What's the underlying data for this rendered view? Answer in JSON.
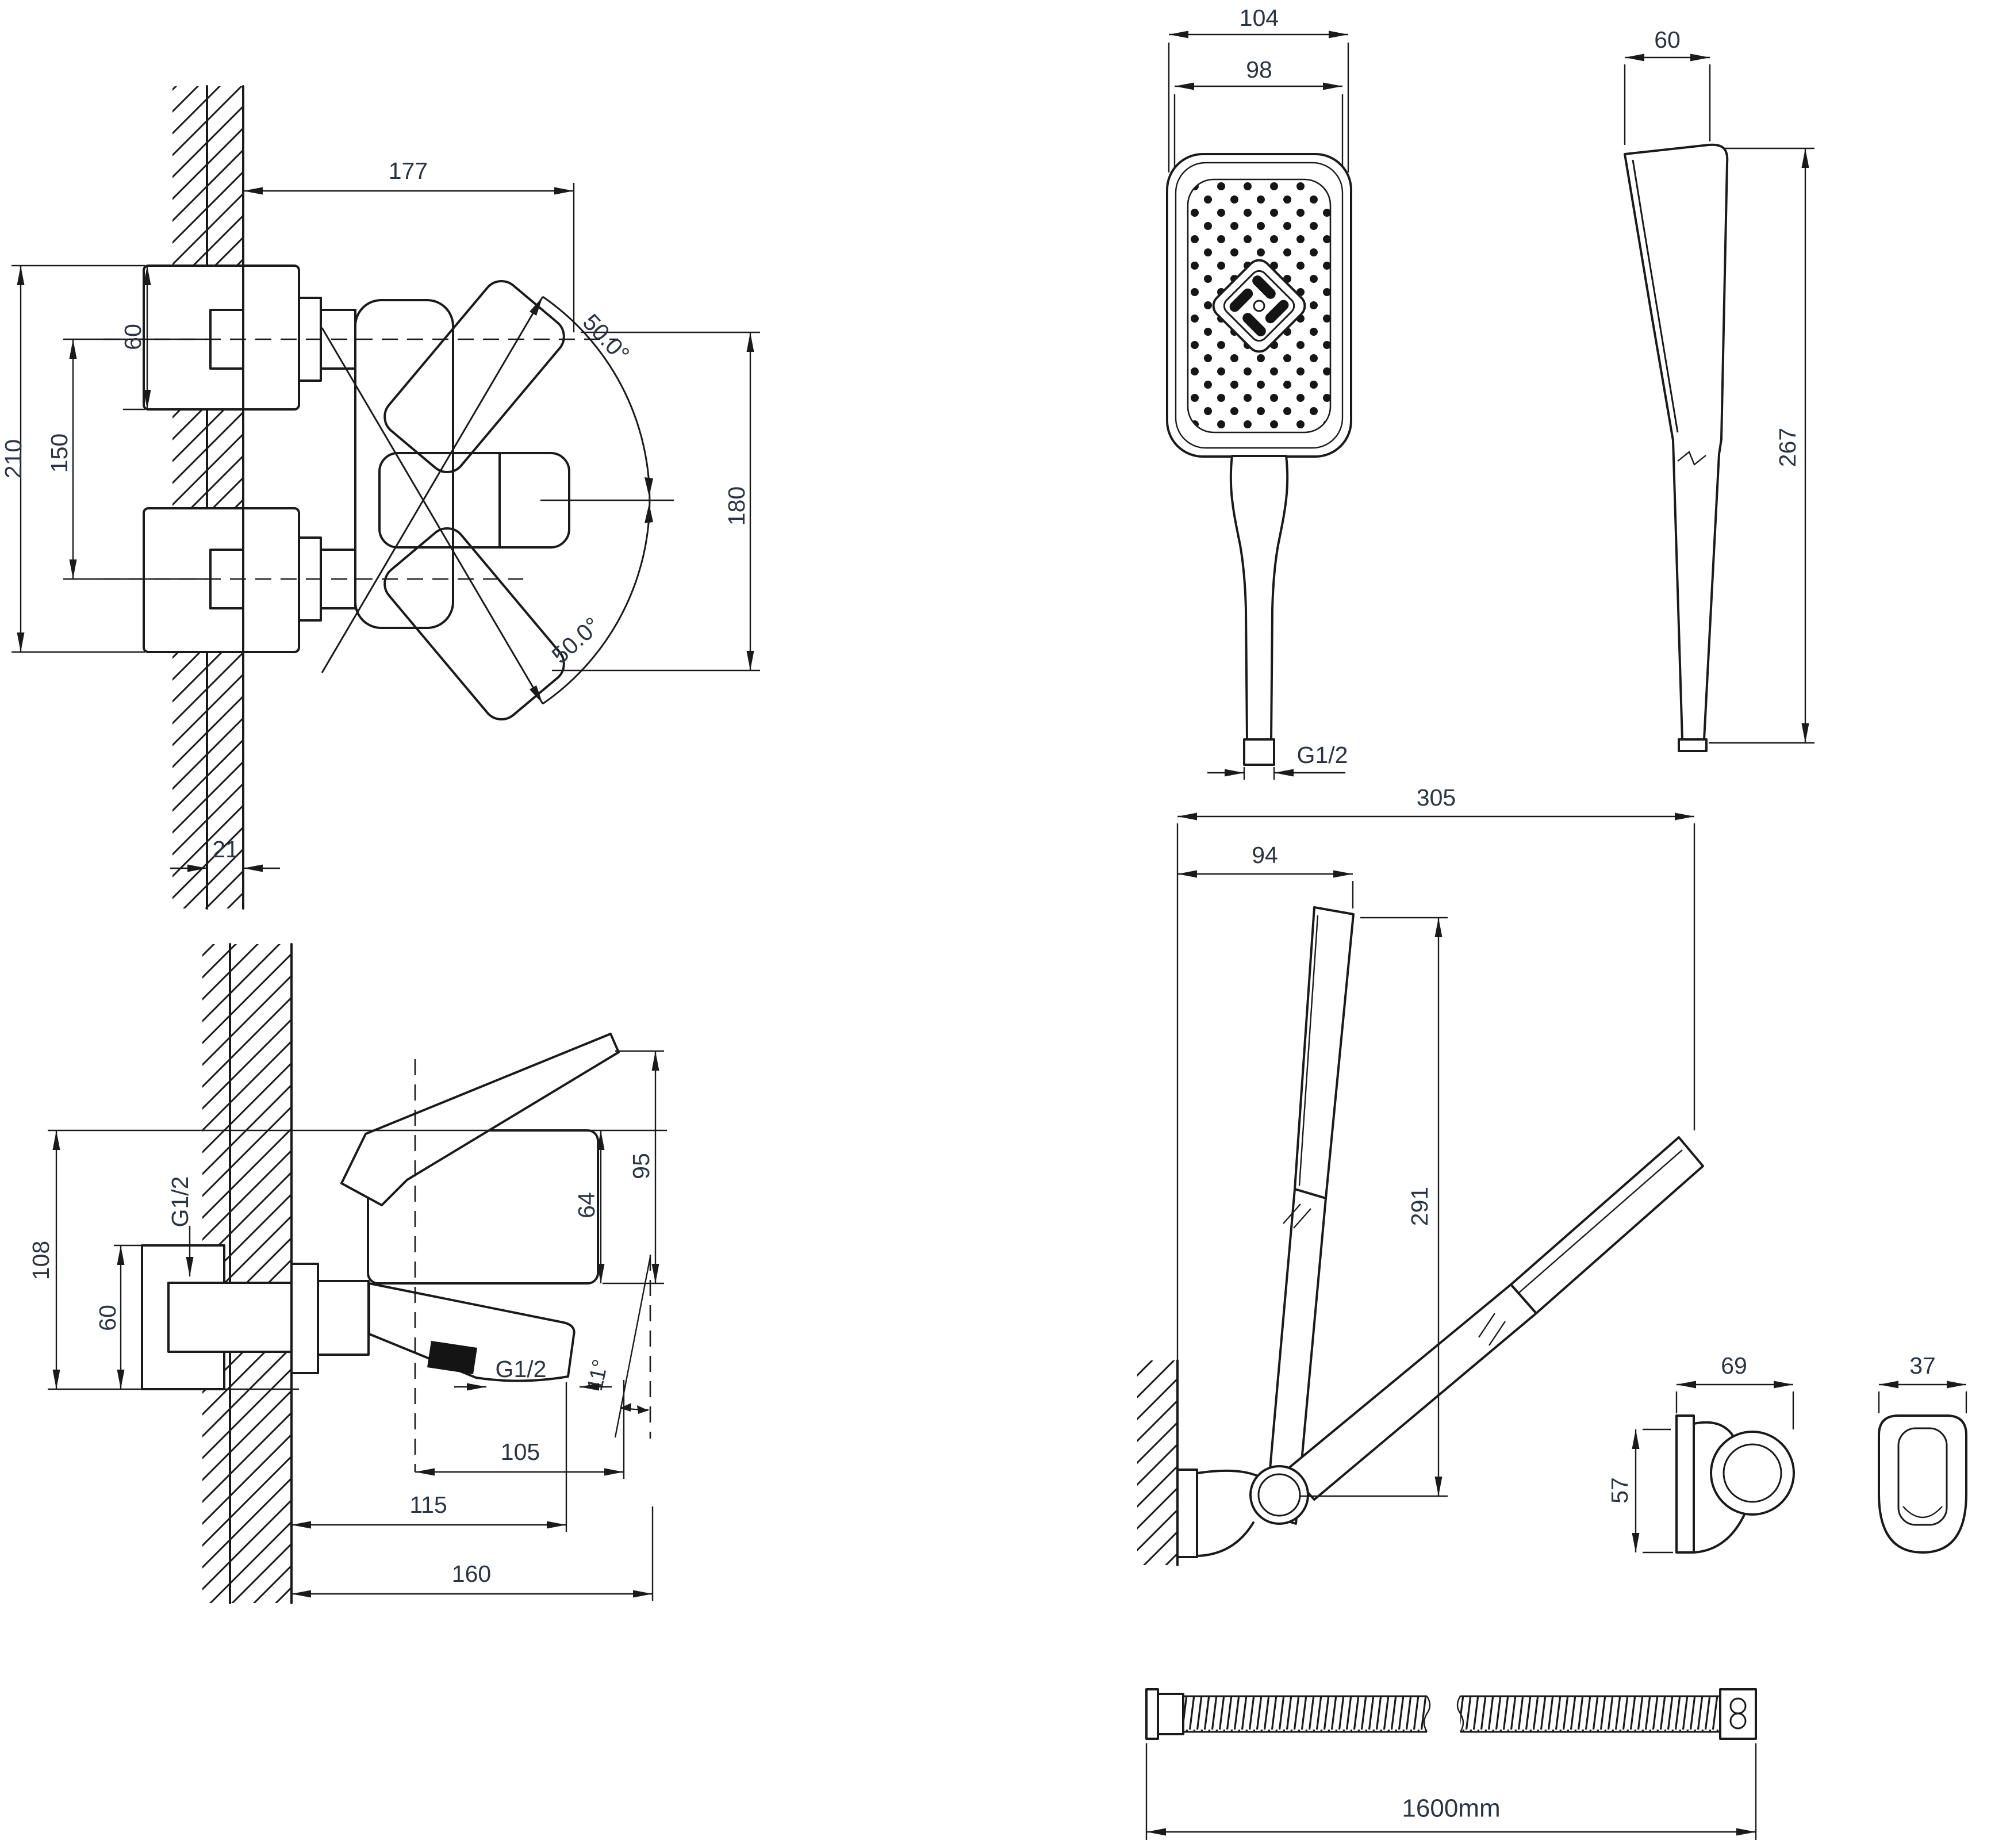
{
  "colors": {
    "ink": "#1a1a1a",
    "label": "#2a3442",
    "paper": "#ffffff"
  },
  "views": {
    "faucet_top": {
      "width": "177",
      "flange": "60",
      "spacing": "150",
      "height": "210",
      "swing": "180",
      "wall": "21",
      "angle_up": "50.0°",
      "angle_down": "50.0°"
    },
    "faucet_side": {
      "depth": "108",
      "inlet_thread": "G1/2",
      "flange": "60",
      "height": "95",
      "spout_height": "64",
      "outlet_thread": "G1/2",
      "spout_angle": "11°",
      "aerator_x": "105",
      "spout_x": "115",
      "reach": "160"
    },
    "shower_front": {
      "head_width": "104",
      "face_width": "98",
      "thread": "G1/2"
    },
    "shower_side": {
      "head_depth": "60",
      "length": "267"
    },
    "holder_assembly": {
      "reach": "305",
      "offset": "94",
      "height": "291"
    },
    "holder_side": {
      "width": "69",
      "height": "57"
    },
    "holder_front": {
      "width": "37"
    },
    "hose": {
      "length": "1600mm"
    }
  }
}
